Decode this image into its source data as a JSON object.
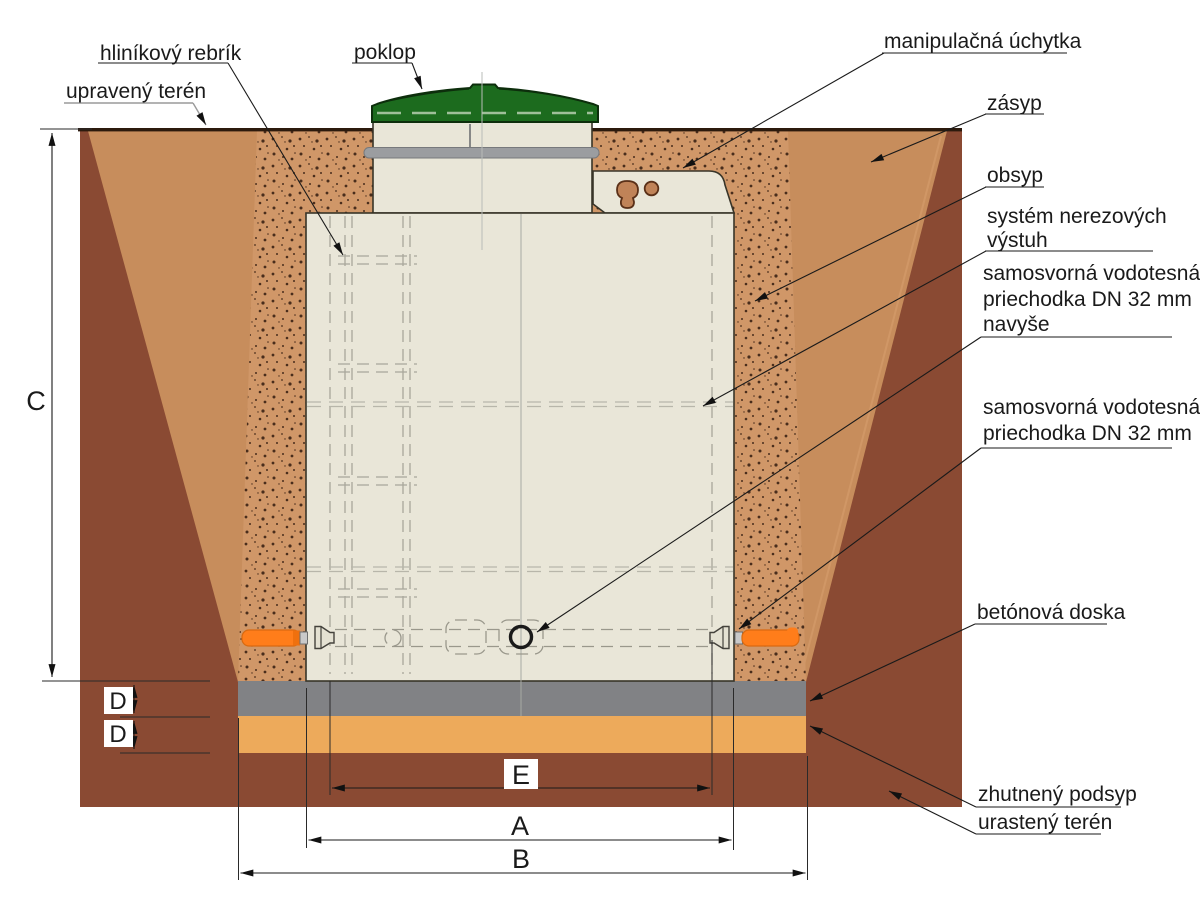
{
  "diagram": {
    "type": "installation-cross-section",
    "language": "sk",
    "labels": {
      "upraveny_teren": "upravený terén",
      "hlinikovy_rebrik": "hliníkový rebrík",
      "poklop": "poklop",
      "manipulacna_uchytka": "manipulačná úchytka",
      "zasyp": "zásyp",
      "obsyp": "obsyp",
      "system_nerez_line1": "systém nerezových",
      "system_nerez_line2": "výstuh",
      "priechodka_navyse_line1": "samosvorná vodotesná",
      "priechodka_navyse_line2": "priechodka DN 32 mm",
      "priechodka_navyse_line3": "navyše",
      "priechodka_line1": "samosvorná vodotesná",
      "priechodka_line2": "priechodka DN 32 mm",
      "betonova_doska": "betónová doska",
      "zhutneny_podsyp": "zhutnený podsyp",
      "urasteny_teren": "urastený terén"
    },
    "dimensions": {
      "A": "A",
      "B": "B",
      "C": "C",
      "D1": "D",
      "D2": "D",
      "E": "E"
    },
    "colors": {
      "soil_dark": "#8a4a33",
      "backfill": "#c78d5c",
      "bedding_base": "#d09768",
      "bedding_dot": "#3a2113",
      "tank_cream": "#e9e6d8",
      "lid_green": "#1c6b1e",
      "lid_dash": "#9fbf9a",
      "ring_gray": "#9b9da0",
      "slab_gray": "#818285",
      "sand": "#edaa5b",
      "pipe_orange": "#ff7d1a",
      "cutout_tan": "#c08358",
      "ground_line": "#2c1a0d"
    }
  }
}
